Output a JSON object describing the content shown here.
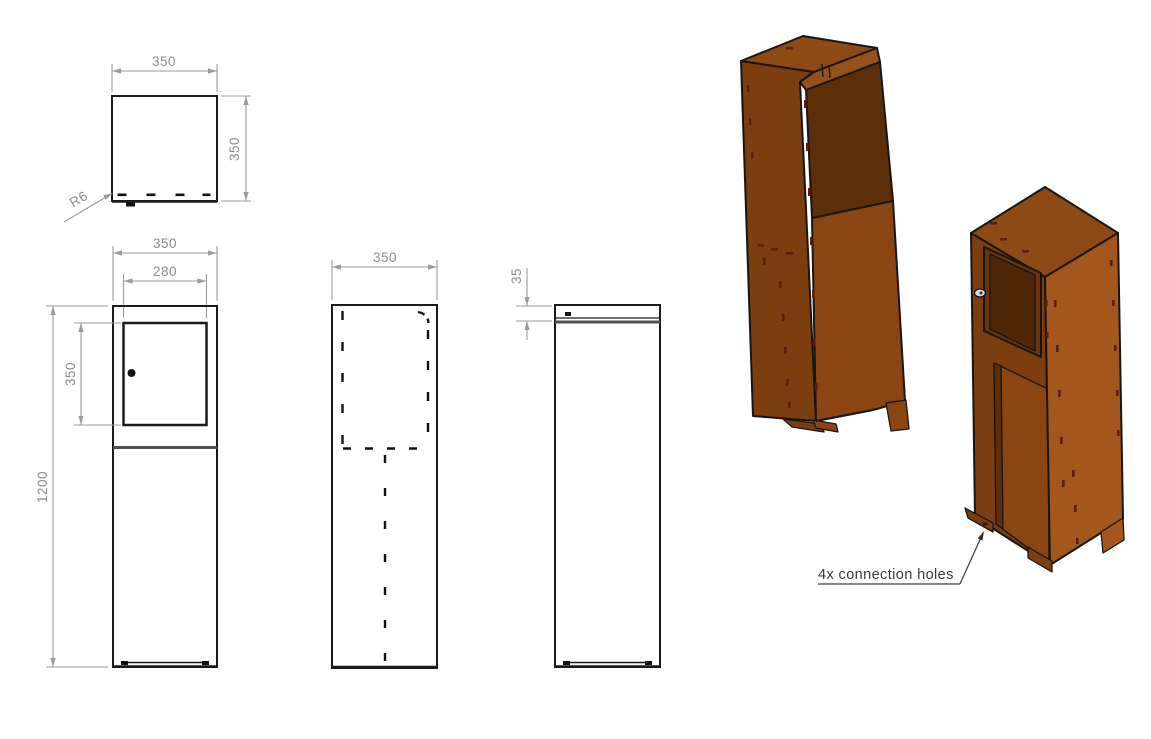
{
  "drawing": {
    "views": {
      "top": {
        "dim_width": "350",
        "dim_depth": "350",
        "radius": "R6"
      },
      "front": {
        "dim_width": "350",
        "dim_door_width": "280",
        "dim_door_height": "350",
        "dim_height": "1200"
      },
      "rear": {
        "dim_width": "350"
      },
      "side": {
        "dim_lid": "35"
      }
    },
    "iso": {
      "annotation": "4x connection holes",
      "colors": {
        "face_top": "#8d4a14",
        "face_left": "#7c3d0f",
        "face_right": "#a4571c",
        "rim": "#96511b",
        "panel_recess": "#5e2e09",
        "panel_door": "#4f2507",
        "interior": "#8a4512",
        "stitch": "#5c1f0e",
        "knob": "#d9d9d9",
        "hole": "#3a1c05"
      }
    },
    "style": {
      "background": "#ffffff",
      "edge_color": "#1a1a1a",
      "dim_line_color": "#9b9b9b",
      "dim_text_color": "#8c8c8c",
      "annotation_color": "#3a3a3a"
    }
  }
}
